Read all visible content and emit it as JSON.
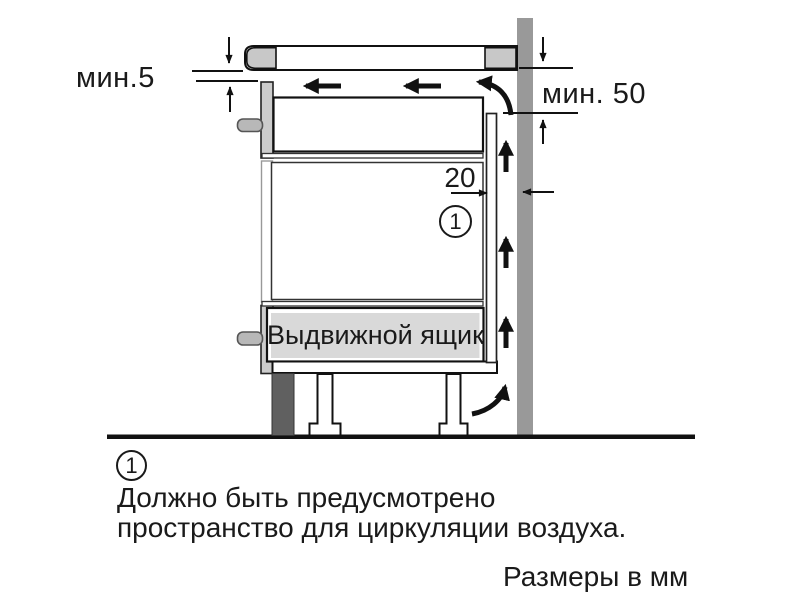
{
  "diagram": {
    "dim_min_top": "мин.5",
    "dim_min_right": "мин. 50",
    "dim_rear_gap": "20",
    "callout_number": "1",
    "drawer_label": "Выдвижной ящик"
  },
  "footnote": {
    "callout_number": "1",
    "line1": "Должно быть предусмотрено",
    "line2": "пространство для циркуляции воздуха."
  },
  "units_caption": "Размеры в мм",
  "colors": {
    "wall": "#999999",
    "cooktop_trim": "#c8c8c8",
    "front_panel": "#cccccc",
    "knob": "#b8b8b8",
    "drawer_fill": "#d9d9d9",
    "plinth": "#606060",
    "outline": "#111111",
    "white": "#ffffff"
  }
}
